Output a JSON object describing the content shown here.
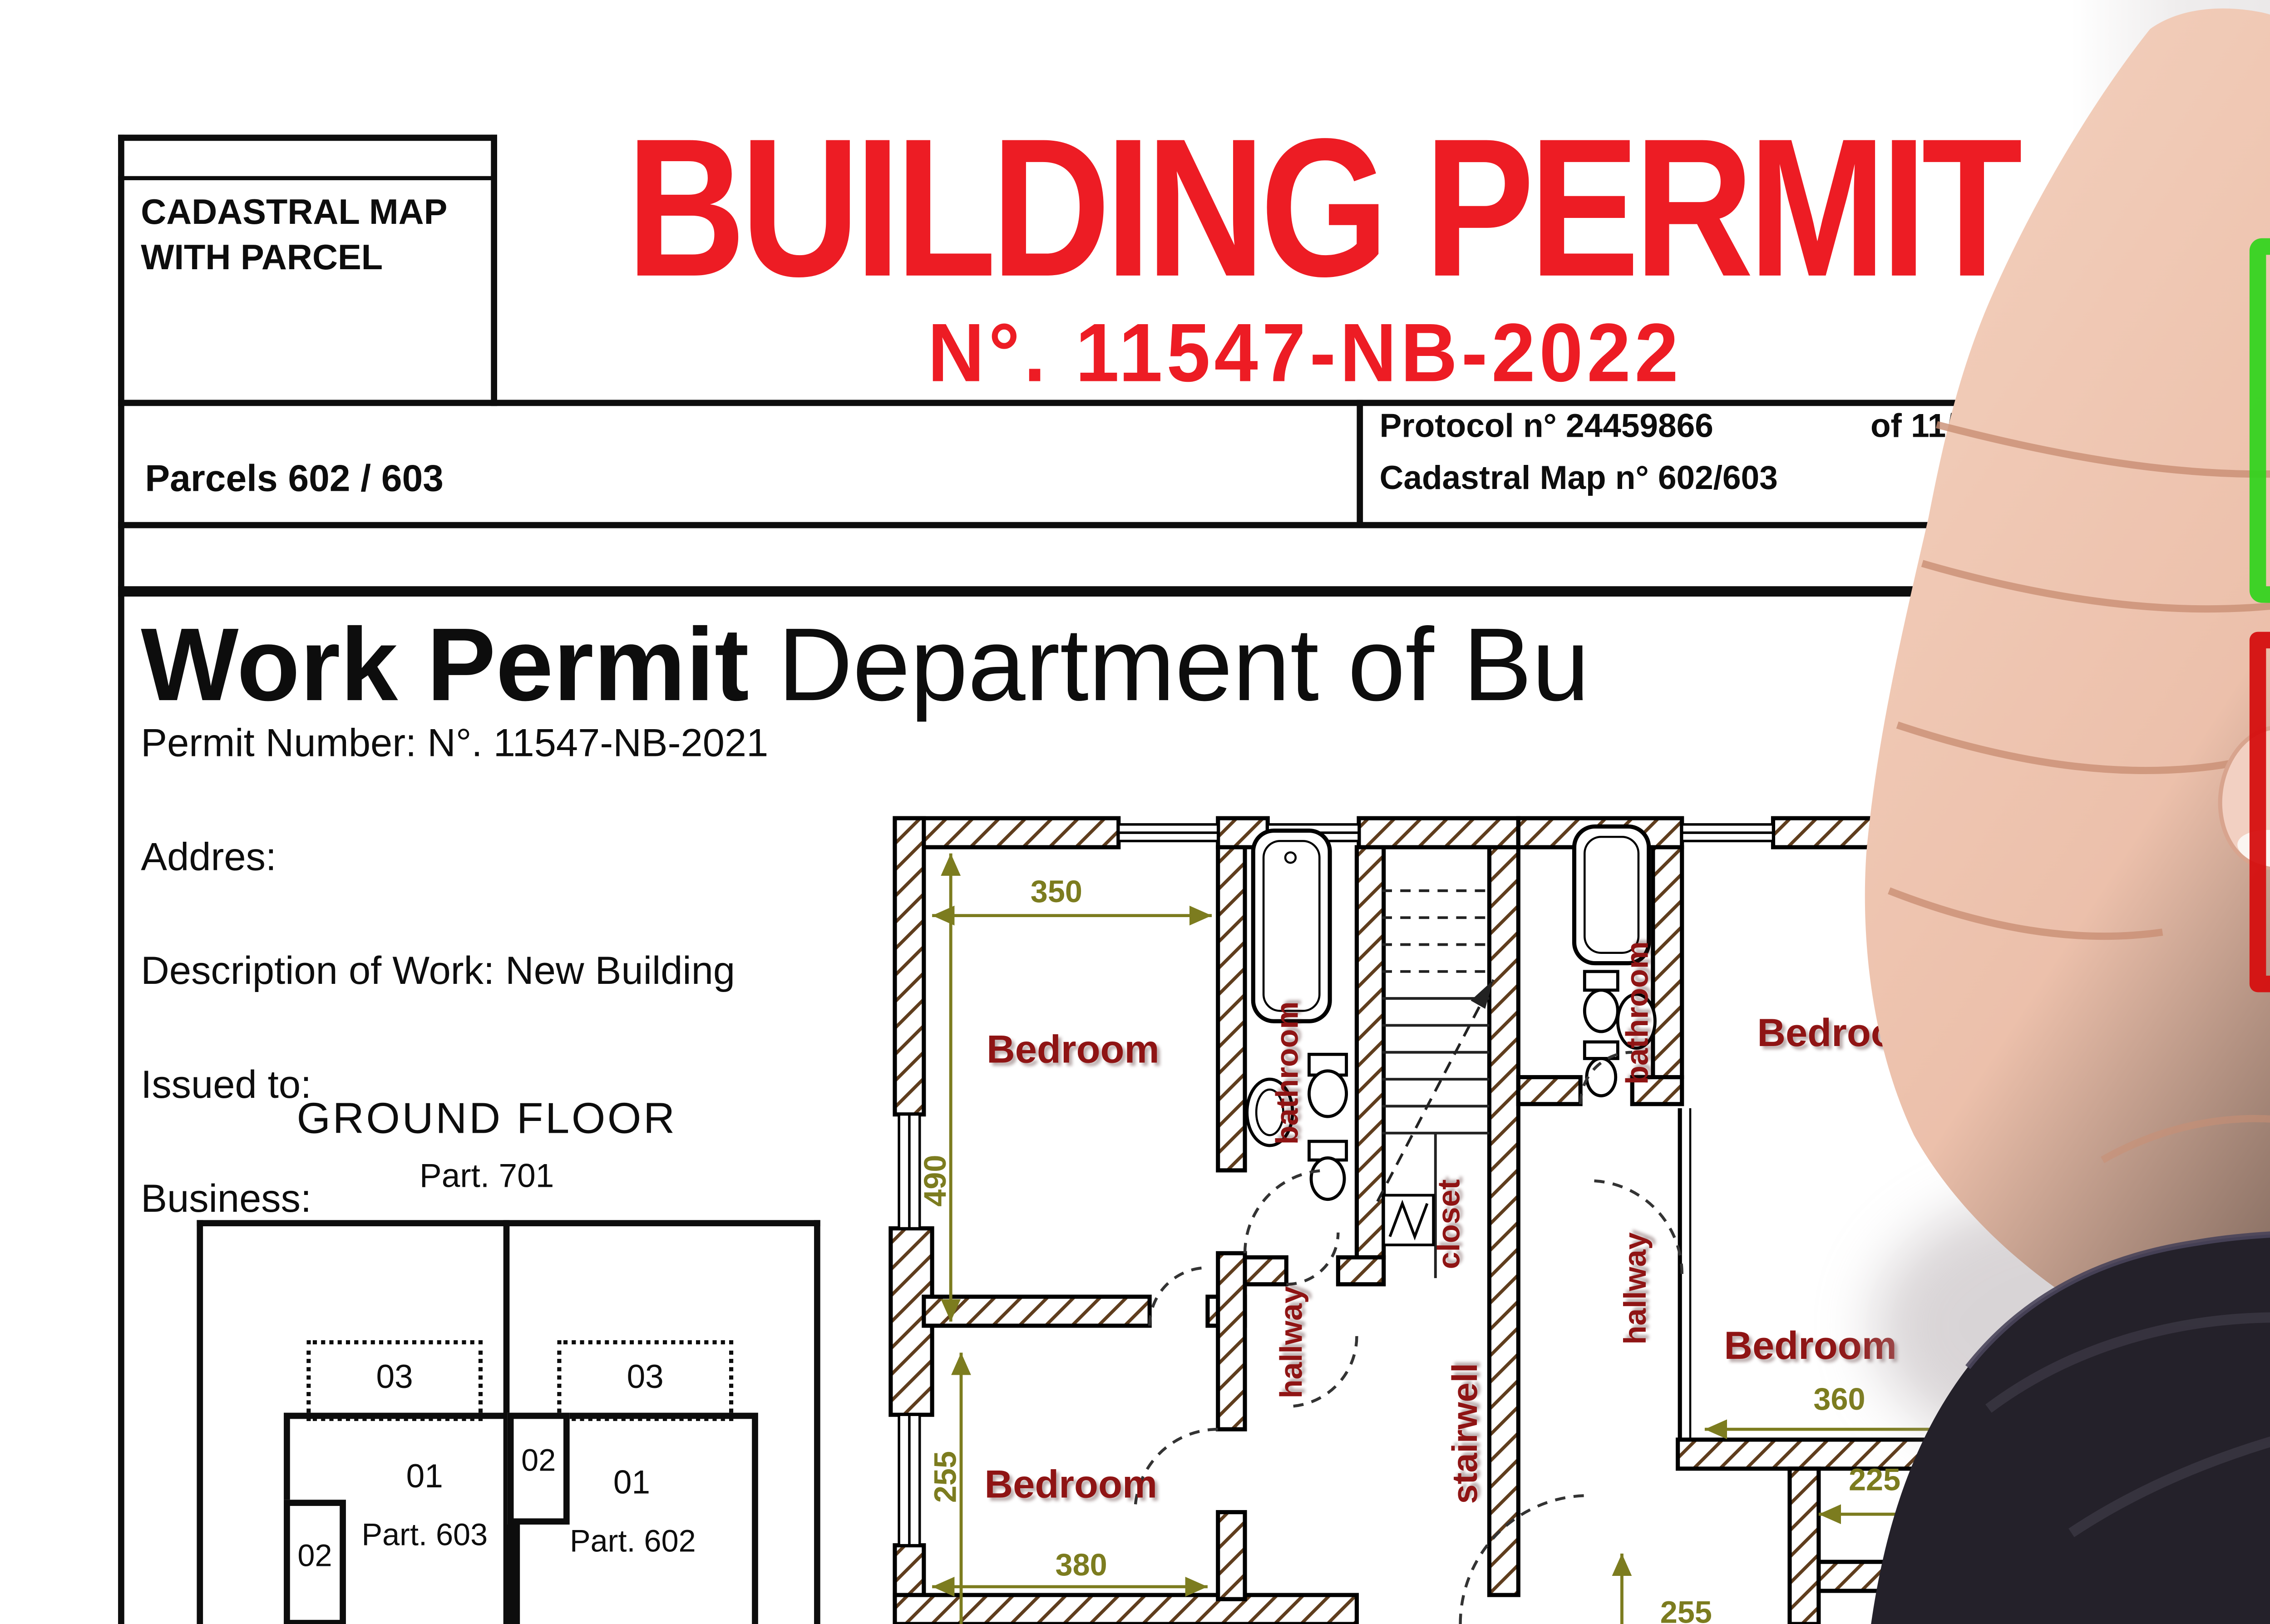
{
  "colors": {
    "title_red": "#ed1c24",
    "stamp_green": "#3bd41e",
    "stamp_red": "#e51212",
    "checkbox_green": "#2fd41b",
    "checkbox_red": "#d50f0f",
    "plan_label_maroon": "#8f1414",
    "plan_dim_olive": "#7c7c1f",
    "wall_hatch_brown": "#5f3d1d",
    "backdrop_gray": "#c9c4c6",
    "sleeve_black": "#24212a",
    "skin_tone": "#ecc0ab",
    "pen_ring_plum": "#6d3356"
  },
  "document": {
    "cadastral_box": {
      "line1": "CADASTRAL MAP",
      "line2": "WITH PARCEL"
    },
    "title": "BUILDING PERMIT",
    "subtitle": "N°. 11547-NB-2022",
    "parcels_label": "Parcels 602 / 603",
    "protocol_number": "Protocol n° 24459866",
    "protocol_date_fragment": "of 11/",
    "cadastral_map_number": "Cadastral Map n° 602/603",
    "heading_bold": "Work Permit",
    "heading_rest": "Department of Bu",
    "fields": [
      "Permit Number: N°. 11547-NB-2021",
      "Addres:",
      "Description of Work: New Building",
      "Issued to:",
      "Business:"
    ],
    "plan_title": "GROUND FLOOR",
    "plan_subtitle": "Part. 701"
  },
  "parcel_diagram": {
    "left_unit_03": "03",
    "right_unit_03": "03",
    "mid_unit_02": "02",
    "left_unit_02": "02",
    "left_unit_01": "01",
    "left_parcel": "Part. 603",
    "right_unit_01": "01",
    "right_parcel": "Part. 602"
  },
  "floor_plan": {
    "rooms": {
      "bedroom_top_left": "Bedroom",
      "bedroom_bottom_left": "Bedroom",
      "bedroom_top_right": "Bedroom",
      "bedroom_bottom_right": "Bedroom",
      "bathroom_left": "bathroom",
      "bathroom_right": "bathroom",
      "closet": "closet",
      "stairwell": "stairwell",
      "hallway_left": "hallway",
      "hallway_right": "hallway"
    },
    "dimensions": {
      "top_bedroom_width": "350",
      "left_height": "490",
      "bottom_bedroom_height": "255",
      "bottom_bedroom_width": "380",
      "right_bedroom_width": "360",
      "right_lower_width": "225",
      "right_lower_height": "255"
    }
  },
  "stamps": {
    "approved": "APPROVED",
    "approved_ghost": "APPROVED",
    "rejected": "REJECTED"
  }
}
